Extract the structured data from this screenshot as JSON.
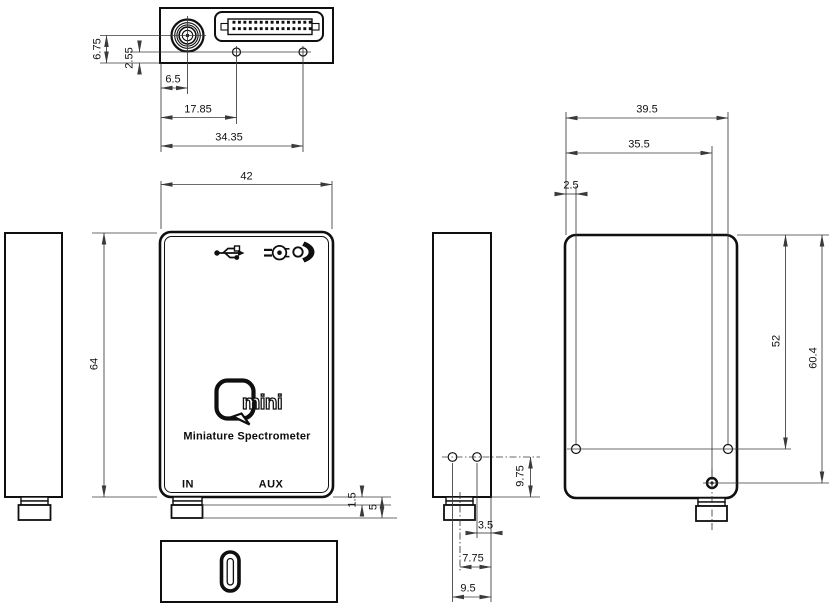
{
  "device": {
    "logo_mark": "Q",
    "logo_text": "mini",
    "subtitle": "Miniature Spectrometer",
    "port_in_label": "IN",
    "port_aux_label": "AUX"
  },
  "dimensions_mm": {
    "top_view": {
      "sma_center_from_bottom": "6.75",
      "holes_from_bottom": "2.55",
      "sma_center_from_left": "6.5",
      "hole1_from_left": "17.85",
      "hole2_from_left": "34.35"
    },
    "front_view": {
      "body_width": "42",
      "body_height": "64",
      "usb_step_height": "1.5",
      "usb_total_height": "5"
    },
    "side_view": {
      "holes_from_bottom": "9.75",
      "hole2_from_back": "3.5",
      "usb_center_from_back": "7.75",
      "hole1_from_back": "9.5"
    },
    "back_view": {
      "hole_right_from_left": "39.5",
      "hole_lower_from_left": "35.5",
      "hole_left_from_left": "2.5",
      "holes_from_top": "52",
      "hole_lower_from_top": "60.4"
    }
  },
  "icons": {
    "usb": "usb-trident-icon",
    "trigger": "external-trigger-plug-icon",
    "status_led": "status-led-icon",
    "usb_c": "usb-c-port-icon",
    "sma": "sma-optical-connector",
    "aux_header": "aux-pin-header-connector"
  },
  "colors": {
    "body_line": "#0f0f0f",
    "dimension_line": "#3a3a3a",
    "background": "#ffffff"
  }
}
